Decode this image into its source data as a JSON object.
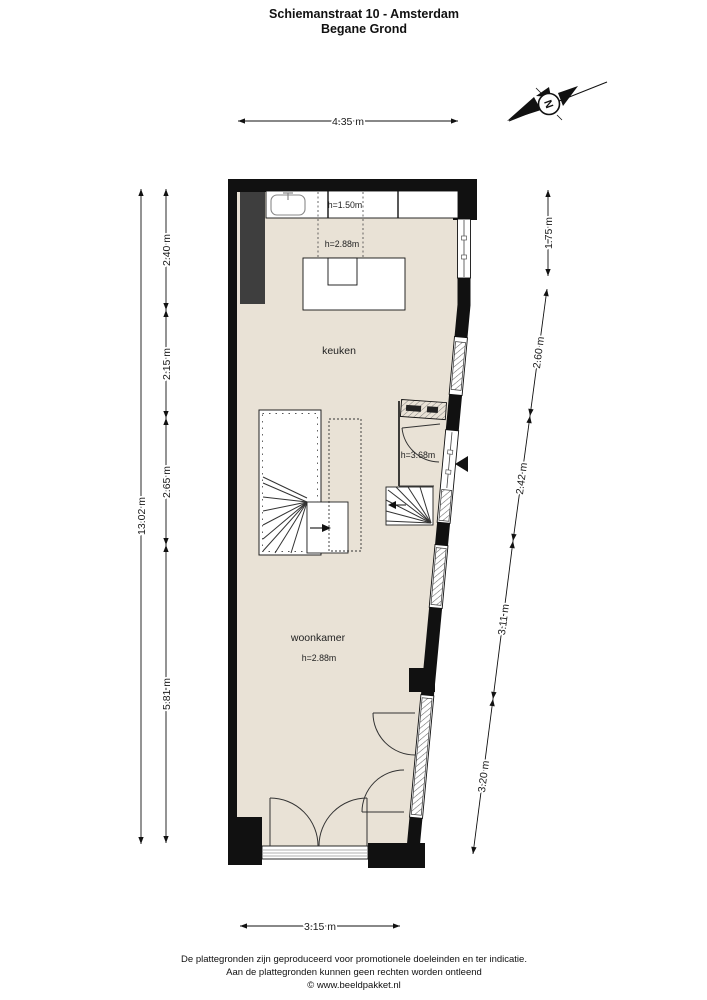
{
  "title": {
    "line1": "Schiemanstraat 10 - Amsterdam",
    "line2": "Begane Grond"
  },
  "compass": {
    "north_letter": "N"
  },
  "plan": {
    "rooms": [
      {
        "name": "keuken",
        "label": "keuken",
        "ceiling_height": "h=2.88m",
        "counter_height": "h=1.50m"
      },
      {
        "name": "woonkamer",
        "label": "woonkamer",
        "ceiling_height": "h=2.88m"
      },
      {
        "name": "entree",
        "ceiling_height": "h=3.68m"
      }
    ]
  },
  "dimensions": {
    "top_width": "4.35 m",
    "bottom_width": "3.15 m",
    "left_total_height": "13.02 m",
    "left_segments": [
      "2.40 m",
      "2.15 m",
      "2.65 m",
      "5.81 m"
    ],
    "right_top": "1.75 m",
    "right_slanted_segments": [
      "2.60 m",
      "2.42 m",
      "3.11 m",
      "3.20 m"
    ]
  },
  "footer": {
    "disclaimer_line1": "De plattegronden zijn geproduceerd voor promotionele doeleinden en ter indicatie.",
    "disclaimer_line2": "Aan de plattegronden kunnen geen rechten worden ontleend",
    "credit": "© www.beeldpakket.nl"
  },
  "colors": {
    "floor": "#e9e2d6",
    "wall": "#111111",
    "dark_unit": "#3e3e3e",
    "background": "#ffffff"
  }
}
